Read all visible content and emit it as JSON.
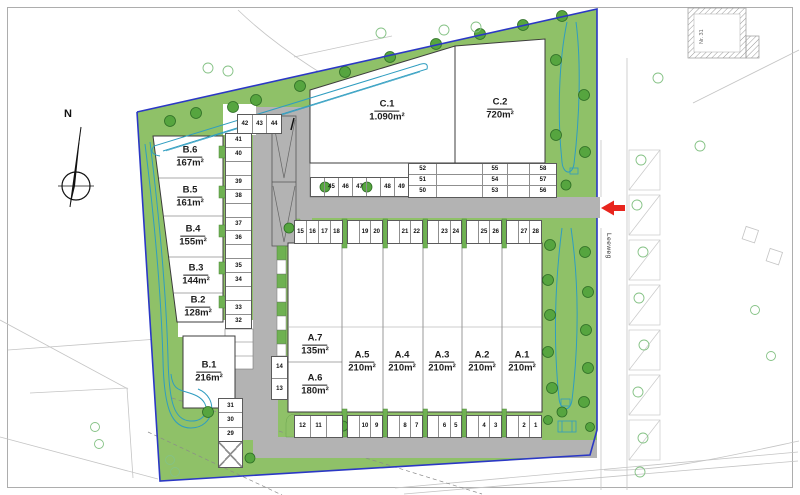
{
  "plan": {
    "compass_label": "N",
    "street_name": "Leeweg",
    "neighbor_label": "Nr. 31"
  },
  "units": {
    "b6": {
      "name": "B.6",
      "area": "167m²"
    },
    "b5": {
      "name": "B.5",
      "area": "161m²"
    },
    "b4": {
      "name": "B.4",
      "area": "155m²"
    },
    "b3": {
      "name": "B.3",
      "area": "144m²"
    },
    "b2": {
      "name": "B.2",
      "area": "128m²"
    },
    "b1": {
      "name": "B.1",
      "area": "216m²"
    },
    "a7": {
      "name": "A.7",
      "area": "135m²"
    },
    "a6": {
      "name": "A.6",
      "area": "180m²"
    },
    "a5": {
      "name": "A.5",
      "area": "210m²"
    },
    "a4": {
      "name": "A.4",
      "area": "210m²"
    },
    "a3": {
      "name": "A.3",
      "area": "210m²"
    },
    "a2": {
      "name": "A.2",
      "area": "210m²"
    },
    "a1": {
      "name": "A.1",
      "area": "210m²"
    },
    "c1": {
      "name": "C.1",
      "area": "1.090m²"
    },
    "c2": {
      "name": "C.2",
      "area": "720m²"
    }
  },
  "parking": {
    "top_row": [
      "42",
      "43",
      "44"
    ],
    "b_column": [
      "41",
      "40",
      "",
      "39",
      "38",
      "",
      "37",
      "36",
      "",
      "35",
      "34",
      "",
      "33",
      "32"
    ],
    "b1_column": [
      "31",
      "30",
      "29"
    ],
    "a_west_column": [
      "14",
      "13"
    ],
    "mid_row_groups": [
      [
        "15",
        "16",
        "17",
        "18"
      ],
      [
        "",
        "19",
        "20"
      ],
      [
        "",
        "21",
        "22"
      ],
      [
        "",
        "23",
        "24"
      ],
      [
        "",
        "25",
        "26"
      ],
      [
        "",
        "27",
        "28"
      ]
    ],
    "bottom_row_groups": [
      [
        "12",
        "11",
        ""
      ],
      [
        "",
        "10",
        "9"
      ],
      [
        "",
        "8",
        "7"
      ],
      [
        "",
        "6",
        "5"
      ],
      [
        "",
        "4",
        "3"
      ],
      [
        "",
        "2",
        "1"
      ]
    ],
    "c1_row": [
      "",
      "45",
      "46",
      "47",
      "",
      "48",
      "49"
    ],
    "c2_rows": [
      [
        "52",
        "",
        "55",
        "",
        "58"
      ],
      [
        "51",
        "",
        "54",
        "",
        "57"
      ],
      [
        "50",
        "",
        "53",
        "",
        "56"
      ]
    ]
  },
  "colors": {
    "green": "#8fc168",
    "tree_green": "#56a53f",
    "road_gray": "#b3b3b3",
    "boundary_blue": "#2b38c5",
    "swale_teal": "#2f9dc0",
    "arrow_red": "#e8251d"
  }
}
